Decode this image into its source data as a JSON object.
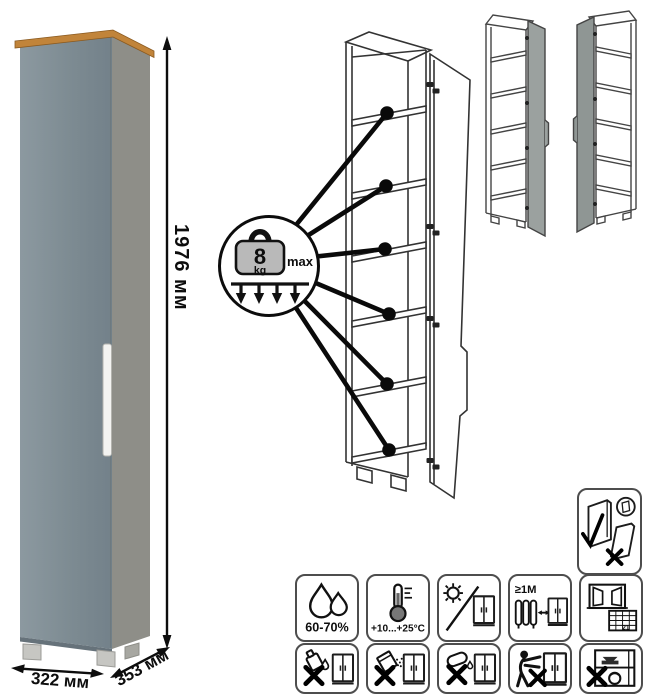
{
  "product": {
    "dimensions": {
      "height": "1976 мм",
      "width": "322 мм",
      "depth": "353 мм"
    },
    "load_badge": {
      "value": "8",
      "unit": "kg",
      "max_label": "max"
    },
    "colors": {
      "door_front": "#7e8c93",
      "side_panel": "#8e8e88",
      "wood_top": "#c1843a",
      "handle": "#f3f3f1",
      "variant_door": "#9ba19f",
      "line_art": "#333333"
    }
  },
  "icons": {
    "transport": {
      "name": "carry-panels-vertically-icon"
    },
    "care_row1": [
      {
        "name": "humidity-range-icon",
        "label": "60-70%"
      },
      {
        "name": "temperature-range-icon",
        "label": "+10...+25°C"
      },
      {
        "name": "no-direct-sunlight-icon",
        "label": ""
      },
      {
        "name": "keep-distance-from-heat-icon",
        "label": "≥1M"
      },
      {
        "name": "ventilate-room-icon",
        "label": "21"
      }
    ],
    "care_row2": [
      {
        "name": "no-aggressive-liquids-icon"
      },
      {
        "name": "no-abrasive-powders-icon"
      },
      {
        "name": "no-wet-cleaning-icon"
      },
      {
        "name": "no-climbing-icon"
      },
      {
        "name": "no-heavy-overload-icon"
      }
    ],
    "variants": [
      {
        "name": "door-hinged-right-variant"
      },
      {
        "name": "door-hinged-left-variant"
      }
    ]
  }
}
